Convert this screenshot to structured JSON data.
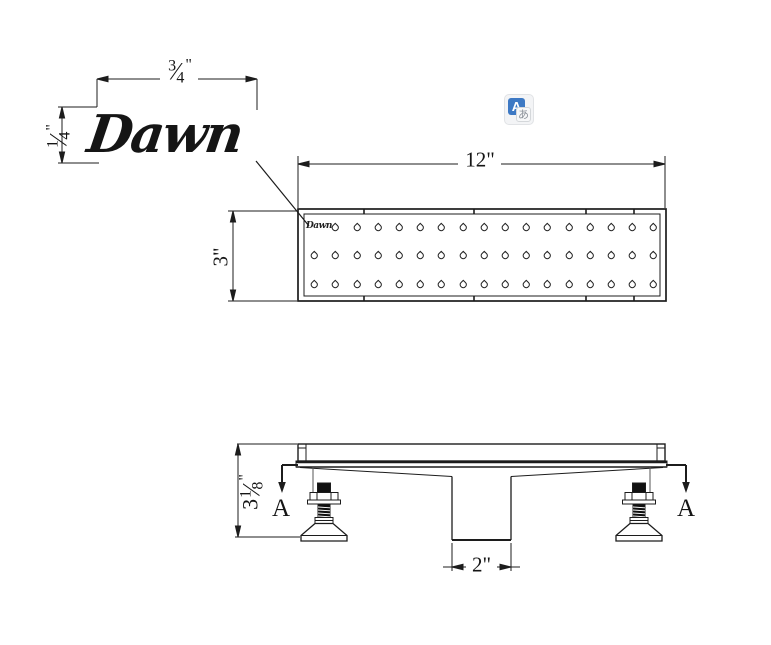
{
  "canvas": {
    "background": "#ffffff",
    "ink": "#151515"
  },
  "logo": {
    "text": "Dawn"
  },
  "plate": {
    "logo_text": "Dawn"
  },
  "translate_icon": {
    "primary_letter": "A",
    "secondary_letter": "あ",
    "blue": "#3d79c4",
    "gray_text": "#8d939b"
  },
  "dimensions": {
    "logo_width": {
      "numerator": "3",
      "denominator": "4",
      "unit": "\""
    },
    "logo_height": {
      "numerator": "1",
      "denominator": "4",
      "unit": "\""
    },
    "drain_length": "12\"",
    "drain_width": "3\"",
    "outlet_width": "2\"",
    "side_height": {
      "whole": "3",
      "numerator": "1",
      "denominator": "8",
      "unit": "\""
    },
    "section_label": "A"
  },
  "grate": {
    "rows": 3,
    "columns": 17,
    "hole_shape": "teardrop"
  }
}
